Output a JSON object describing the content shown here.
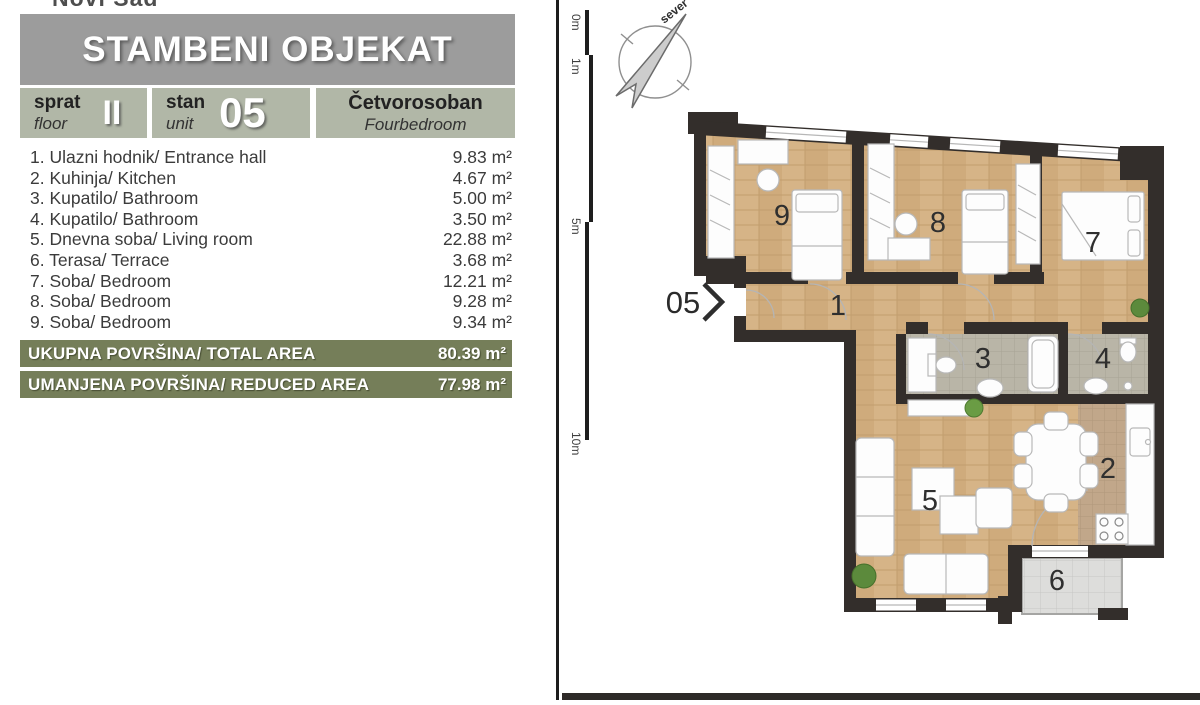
{
  "legend": {
    "clipped_top_text": "Novi Sad",
    "title": "STAMBENI OBJEKAT",
    "floor": {
      "label_sr": "sprat",
      "label_en": "floor",
      "value": "II"
    },
    "unit": {
      "label_sr": "stan",
      "label_en": "unit",
      "value": "05"
    },
    "apartment_type": {
      "label_sr": "Četvorosoban",
      "label_en": "Fourbedroom"
    },
    "rooms": [
      {
        "label": "1. Ulazni hodnik/ Entrance hall",
        "area": "9.83 m²"
      },
      {
        "label": "2. Kuhinja/ Kitchen",
        "area": "4.67 m²"
      },
      {
        "label": "3. Kupatilo/ Bathroom",
        "area": "5.00 m²"
      },
      {
        "label": "4. Kupatilo/ Bathroom",
        "area": "3.50 m²"
      },
      {
        "label": "5. Dnevna soba/ Living room",
        "area": "22.88 m²"
      },
      {
        "label": "6. Terasa/ Terrace",
        "area": "3.68 m²"
      },
      {
        "label": "7. Soba/ Bedroom",
        "area": "12.21 m²"
      },
      {
        "label": "8. Soba/ Bedroom",
        "area": "9.28 m²"
      },
      {
        "label": "9. Soba/ Bedroom",
        "area": "9.34 m²"
      }
    ],
    "totals": [
      {
        "label": "UKUPNA POVRŠINA/ TOTAL AREA",
        "value": "80.39 m²"
      },
      {
        "label": "UMANJENA POVRŠINA/ REDUCED AREA",
        "value": "77.98 m²"
      }
    ]
  },
  "plan": {
    "compass_label": "sever",
    "scale_labels": [
      "0m",
      "1m",
      "5m",
      "10m"
    ],
    "entrance_label": "05",
    "room_numbers": {
      "hall": "1",
      "kitchen": "2",
      "bath_a": "3",
      "bath_b": "4",
      "living": "5",
      "terrace": "6",
      "bedroom_a": "7",
      "bedroom_b": "8",
      "bedroom_c": "9"
    }
  },
  "colors": {
    "header_gray": "#9c9c9c",
    "info_sage": "#b1b7a7",
    "total_olive": "#757e59",
    "wall_dark": "#332e2b",
    "wood_floor": "#d3b083",
    "bath_tile": "#b9b5a7",
    "terrace_tile": "#dddddb",
    "kitchen_tile": "#c1a78a"
  }
}
